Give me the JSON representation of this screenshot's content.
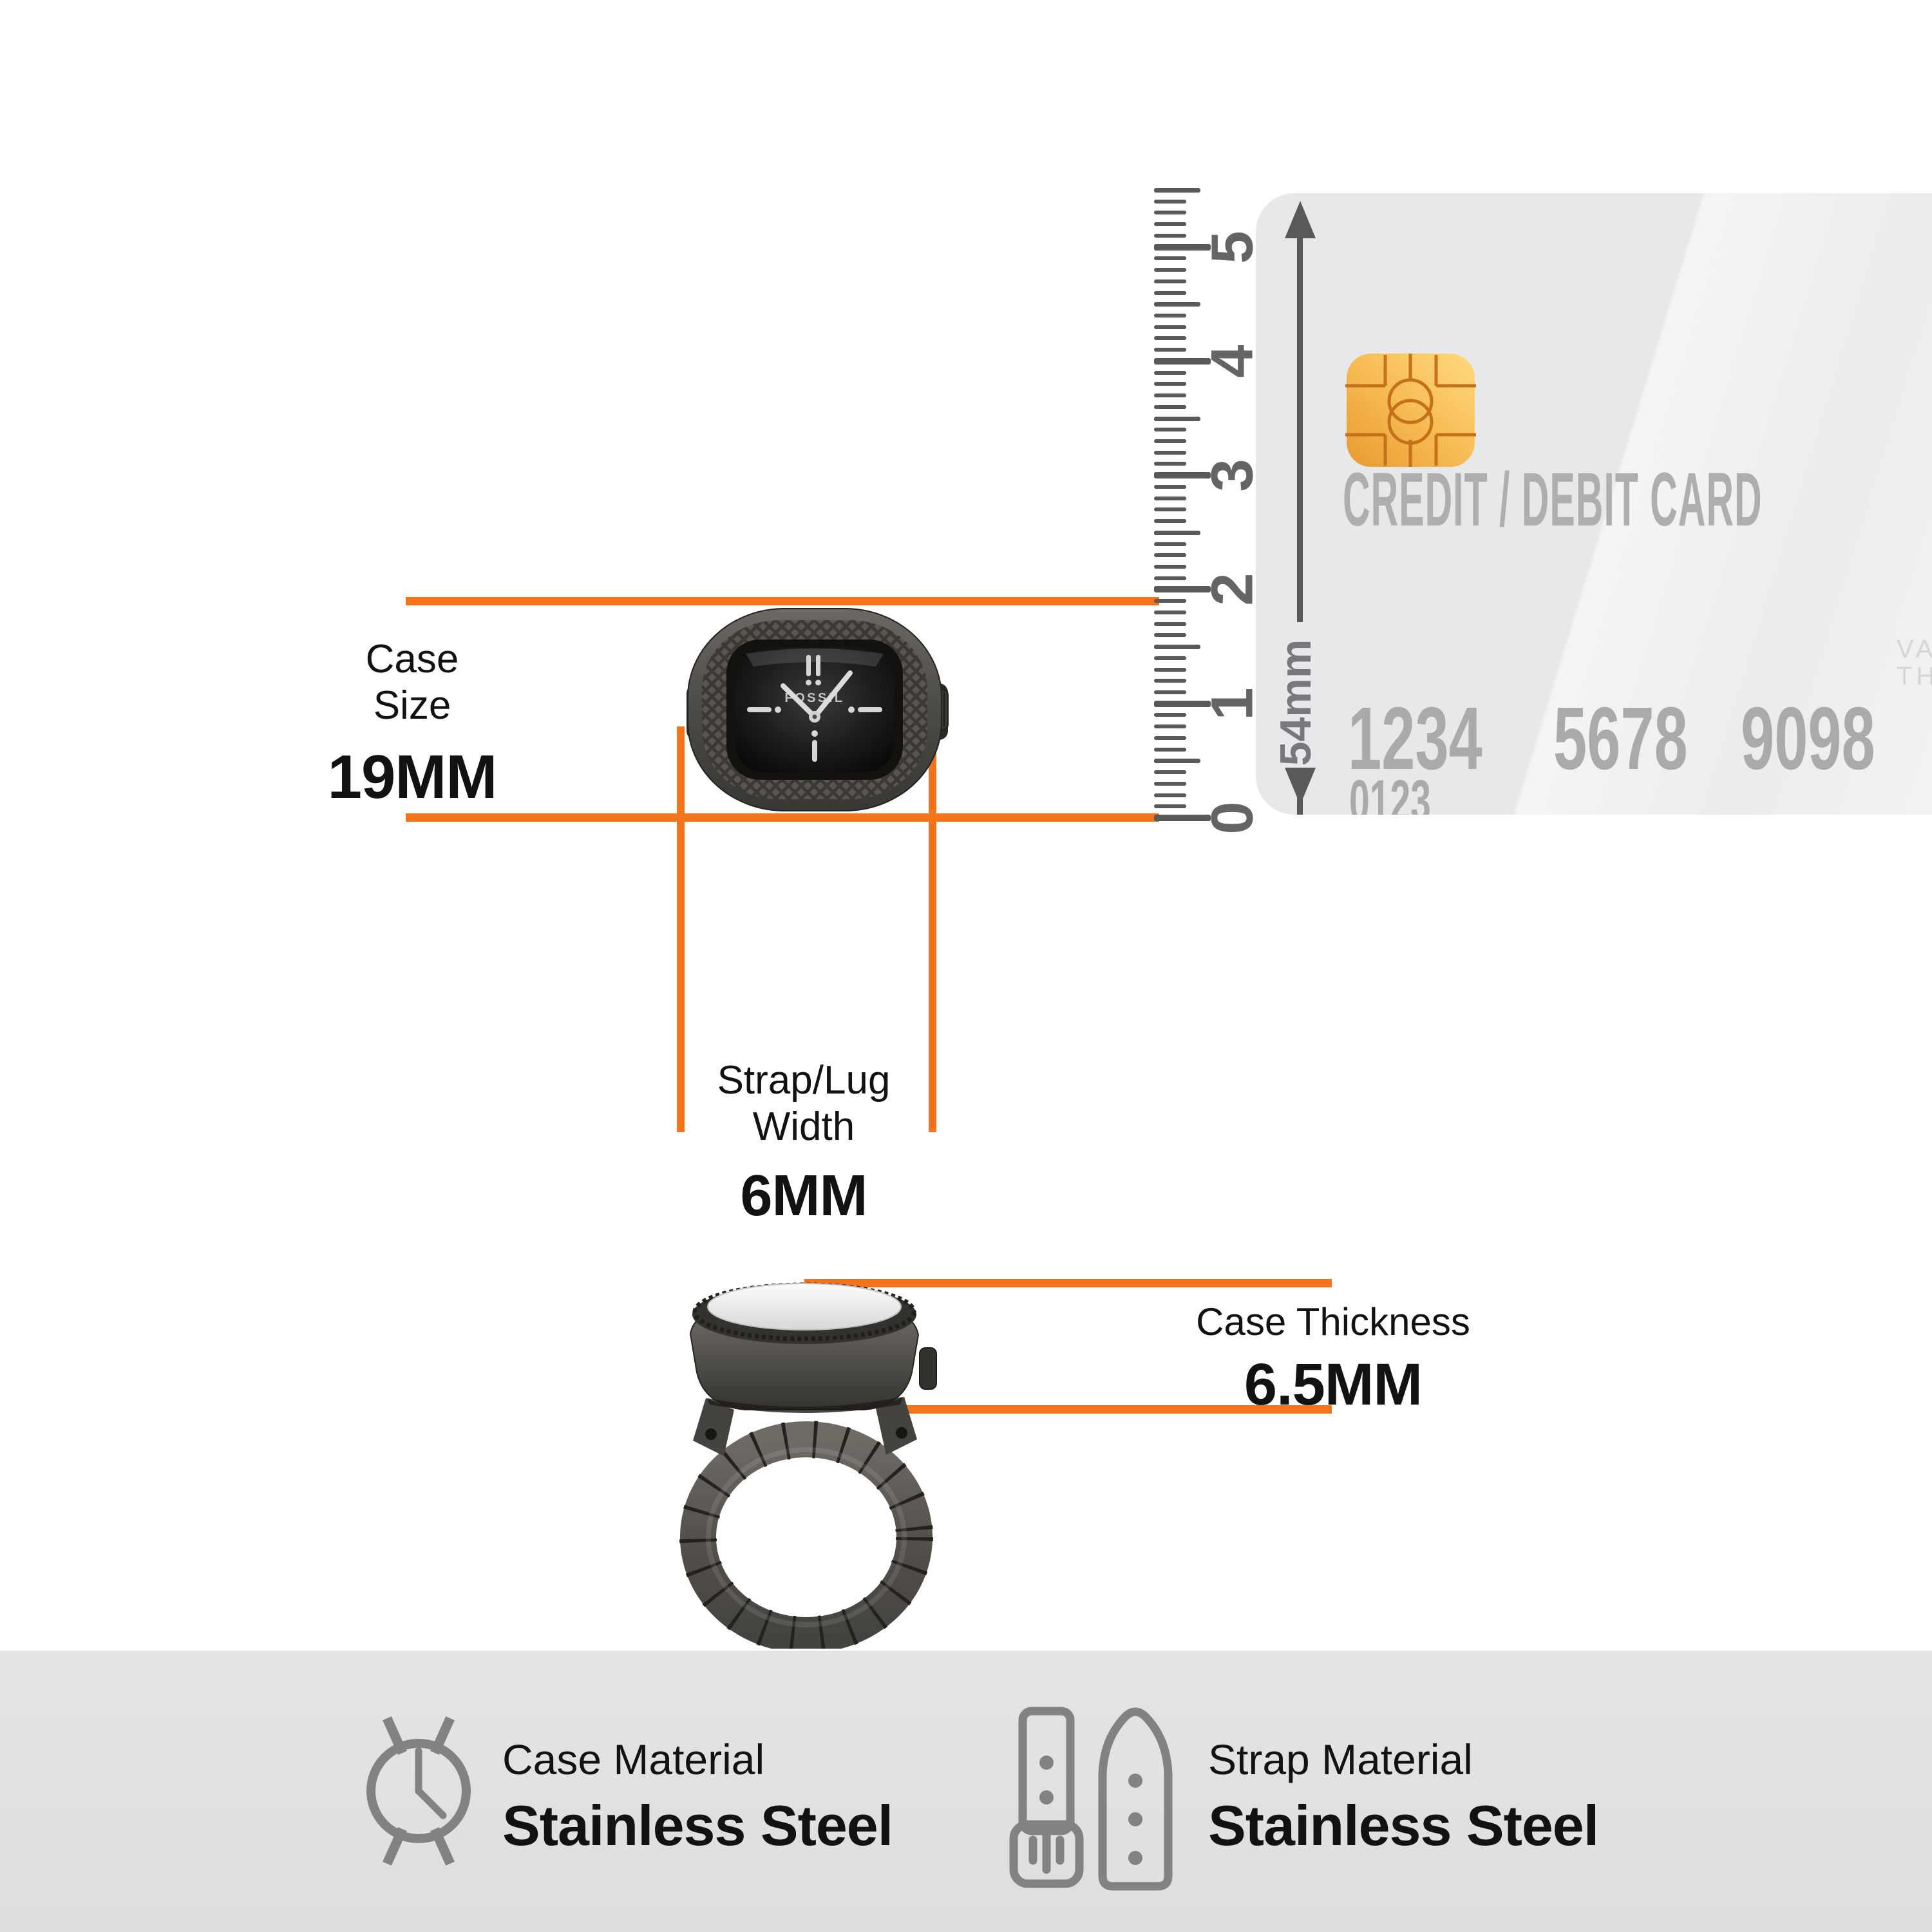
{
  "measure": {
    "case_size_label_1": "Case",
    "case_size_label_2": "Size",
    "case_size_value": "19MM",
    "strap_label_1": "Strap/Lug",
    "strap_label_2": "Width",
    "strap_value": "6MM",
    "thickness_label": "Case Thickness",
    "thickness_value": "6.5MM"
  },
  "ruler": {
    "numbers": [
      "0",
      "1",
      "2",
      "3",
      "4",
      "5"
    ]
  },
  "card": {
    "title": "CREDIT / DEBIT CARD",
    "number_groups": [
      "1234",
      "5678",
      "9098"
    ],
    "small_number": "0123",
    "holder_label": "CARD HOLDER NAME",
    "clipped_line1": "VAL",
    "clipped_line2": "THR",
    "height_label": "54mm"
  },
  "watch": {
    "brand": "FOSSIL"
  },
  "footer": {
    "case_material_label": "Case Material",
    "case_material_value": "Stainless Steel",
    "strap_material_label": "Strap Material",
    "strap_material_value": "Stainless Steel"
  },
  "colors": {
    "accent_orange": "#F4741B",
    "ruler_gray": "#58595B",
    "card_bg": "#E7E8E9",
    "card_text_gray": "#A9AAAC",
    "chip_gold": "#F0AC3F",
    "icon_gray": "#828282",
    "footer_bg": "#E0E0E0"
  }
}
